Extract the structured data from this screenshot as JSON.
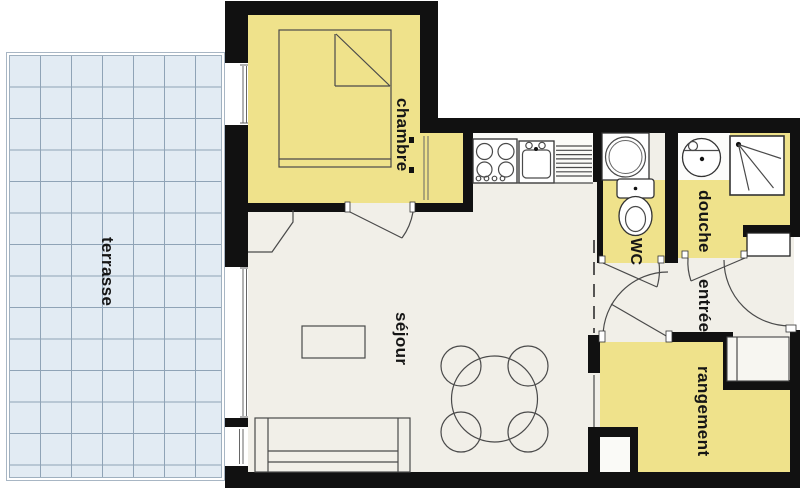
{
  "plan": {
    "type": "apartment-floor-plan",
    "rooms": [
      {
        "id": "terrasse",
        "label": "terrasse"
      },
      {
        "id": "chambre",
        "label": "chambre"
      },
      {
        "id": "sejour",
        "label": "séjour"
      },
      {
        "id": "wc",
        "label": "WC"
      },
      {
        "id": "douche",
        "label": "douche"
      },
      {
        "id": "entree",
        "label": "entrée"
      },
      {
        "id": "rangement",
        "label": "rangement"
      }
    ],
    "colors": {
      "room_fill": "#EFE28B",
      "terrace_fill": "#E2EBF3",
      "terrace_grid": "#8FA3B6",
      "wall": "#111111",
      "floor": "#F1EFE8",
      "outline": "#4a4a4a",
      "background": "#FFFFFF"
    }
  }
}
